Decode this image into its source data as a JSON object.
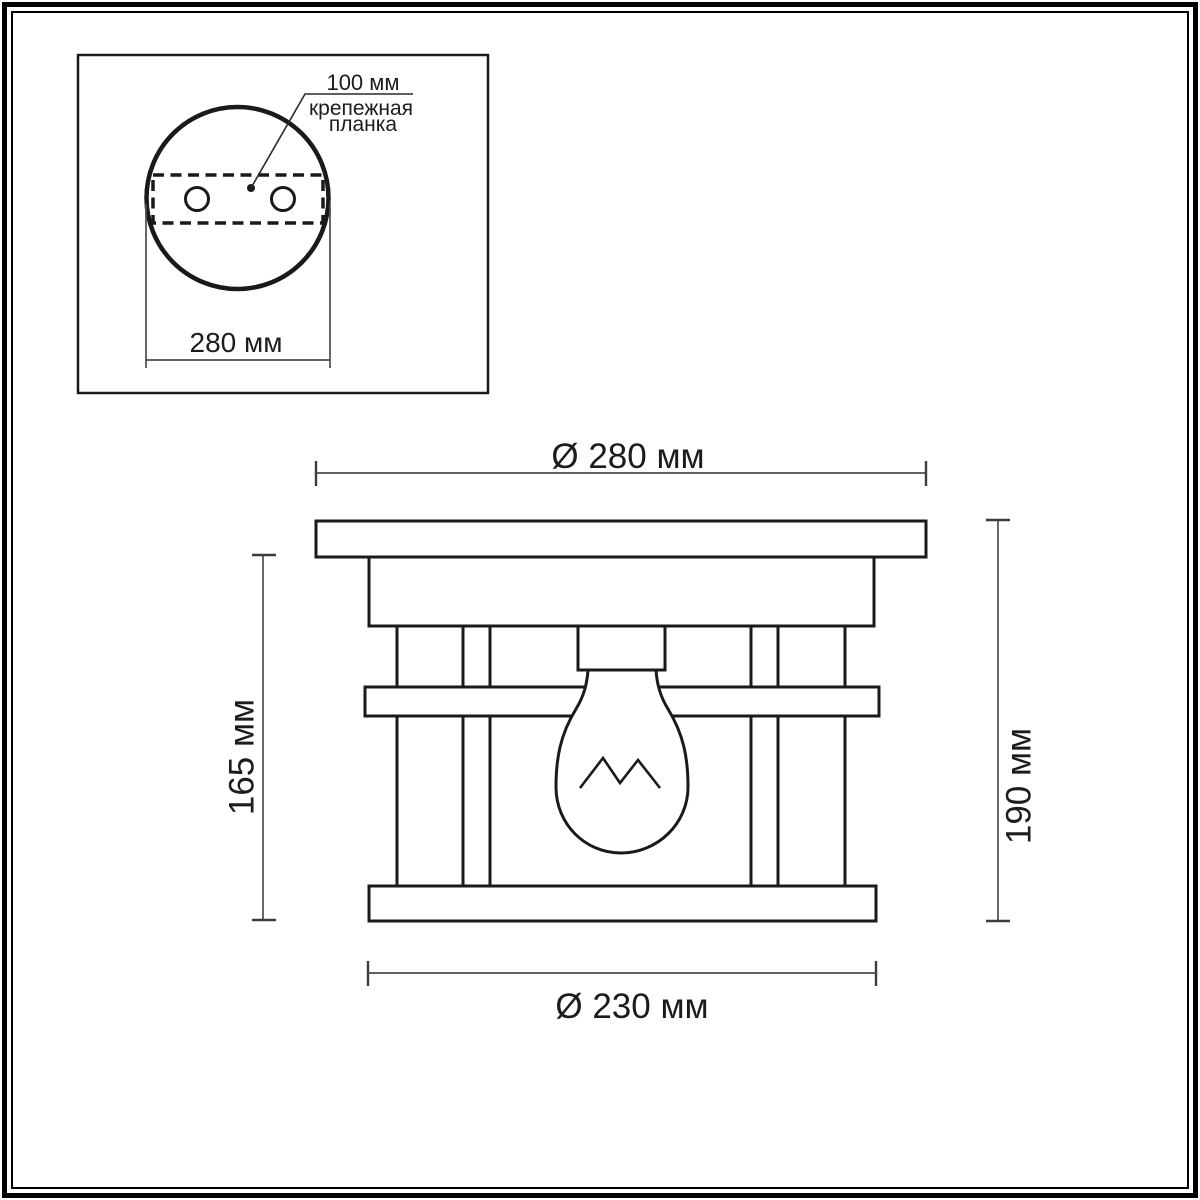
{
  "colors": {
    "background": "#ffffff",
    "frame": "#000000",
    "drawing_line": "#1a1a1a",
    "dimension_line": "#4d4d4d"
  },
  "top_view": {
    "labels": {
      "hole_spacing": "100 мм",
      "mounting_plate_line1": "крепежная",
      "mounting_plate_line2": "планка",
      "diameter": "280 мм"
    }
  },
  "side_view": {
    "labels": {
      "outer_diameter": "Ø 280 мм",
      "cage_diameter": "Ø 230 мм",
      "body_height": "165 мм",
      "total_height": "190 мм"
    }
  }
}
